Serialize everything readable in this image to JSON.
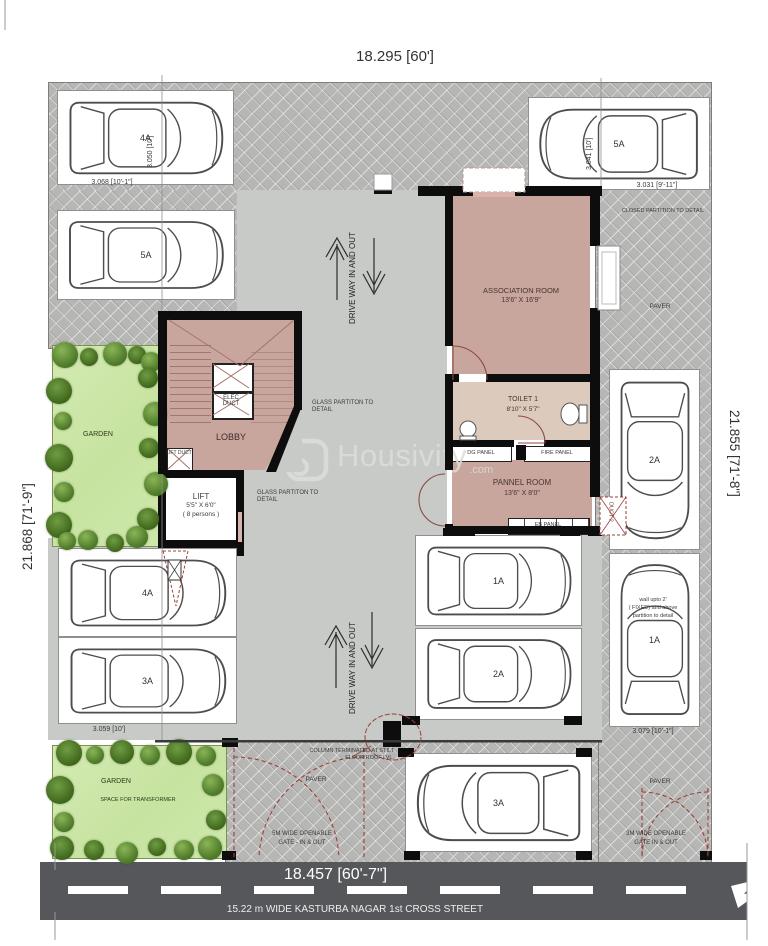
{
  "plan": {
    "dims": {
      "top": "18.295 [60']",
      "left": "21.868 [71'-9\"]",
      "right": "21.855 [71'-8\"]",
      "road": "18.457 [60'-7\"]",
      "street": "15.22 m WIDE KASTURBA NAGAR 1st CROSS STREET",
      "p4a_w": "3.050 [10']",
      "p4a_l": "3.068 [10'-1\"]",
      "p5a_w": "3.041 [10']",
      "p5a_l": "3.031 [9'-11\"]",
      "p3a_l": "3.059 [10']",
      "p1a_l": "3.079 [10'-1\"]"
    },
    "rooms": {
      "association": {
        "name": "ASSOCIATION ROOM",
        "size": "13'6\"  X 16'9\""
      },
      "toilet": {
        "name": "TOILET 1",
        "size": "8'10\" X 5'7\""
      },
      "pannel": {
        "name": "PANNEL ROOM",
        "size": "13'6\"  X 8'0\""
      },
      "lobby": "LOBBY",
      "lift": {
        "name": "LIFT",
        "size": "5'5\" X 6'0\"",
        "capacity": "( 8 persons )"
      }
    },
    "panels": {
      "dg": "DG PANEL",
      "fire": "FIRE PANEL",
      "eb": "EB PANEL",
      "elec_duct": "ELEC DUCT",
      "duct2": "DUCT 2",
      "lift_duct": "LIFT DUCT"
    },
    "notes": {
      "closed_partition": "CLOSED PARTITION TO DETAIL",
      "glass_partition": "GLASS PARTITON TO DETAIL",
      "column": "COLUMN TERMINATED AT STILT FLOOR ROOF LVL.",
      "wall1": "wall upto 2'",
      "wall2": "( FIXED) and above",
      "wall3": "partition to detail",
      "gate5a": "5M WIDE OPENABLE",
      "gate5b": "GATE - IN & OUT",
      "gate3a": "3M WIDE OPENABLE",
      "gate3b": "GATE  IN & OUT",
      "driveway": "DRIVE WAY IN AND OUT",
      "garden": "GARDEN",
      "transformer": "SPACE FOR TRANSFORMER",
      "paver": "PAVER"
    },
    "watermark": {
      "brand": "Housivity",
      "tld": ".com"
    },
    "parking": {
      "spots": [
        {
          "label": "4A",
          "x": 57,
          "y": 90,
          "w": 175,
          "h": 93,
          "dir": "e"
        },
        {
          "label": "5A",
          "x": 528,
          "y": 97,
          "w": 180,
          "h": 91,
          "dir": "w"
        },
        {
          "label": "5A",
          "x": 57,
          "y": 210,
          "w": 176,
          "h": 88,
          "dir": "e"
        },
        {
          "label": "4A",
          "x": 58,
          "y": 548,
          "w": 177,
          "h": 87,
          "dir": "e"
        },
        {
          "label": "3A",
          "x": 58,
          "y": 637,
          "w": 177,
          "h": 85,
          "dir": "e"
        },
        {
          "label": "1A",
          "x": 415,
          "y": 535,
          "w": 165,
          "h": 89,
          "dir": "e"
        },
        {
          "label": "2A",
          "x": 415,
          "y": 628,
          "w": 165,
          "h": 90,
          "dir": "e"
        },
        {
          "label": "2A",
          "x": 609,
          "y": 369,
          "w": 89,
          "h": 179,
          "dir": "s"
        },
        {
          "label": "1A",
          "x": 609,
          "y": 553,
          "w": 89,
          "h": 172,
          "dir": "n"
        },
        {
          "label": "3A",
          "x": 405,
          "y": 753,
          "w": 185,
          "h": 97,
          "dir": "w"
        }
      ]
    }
  }
}
